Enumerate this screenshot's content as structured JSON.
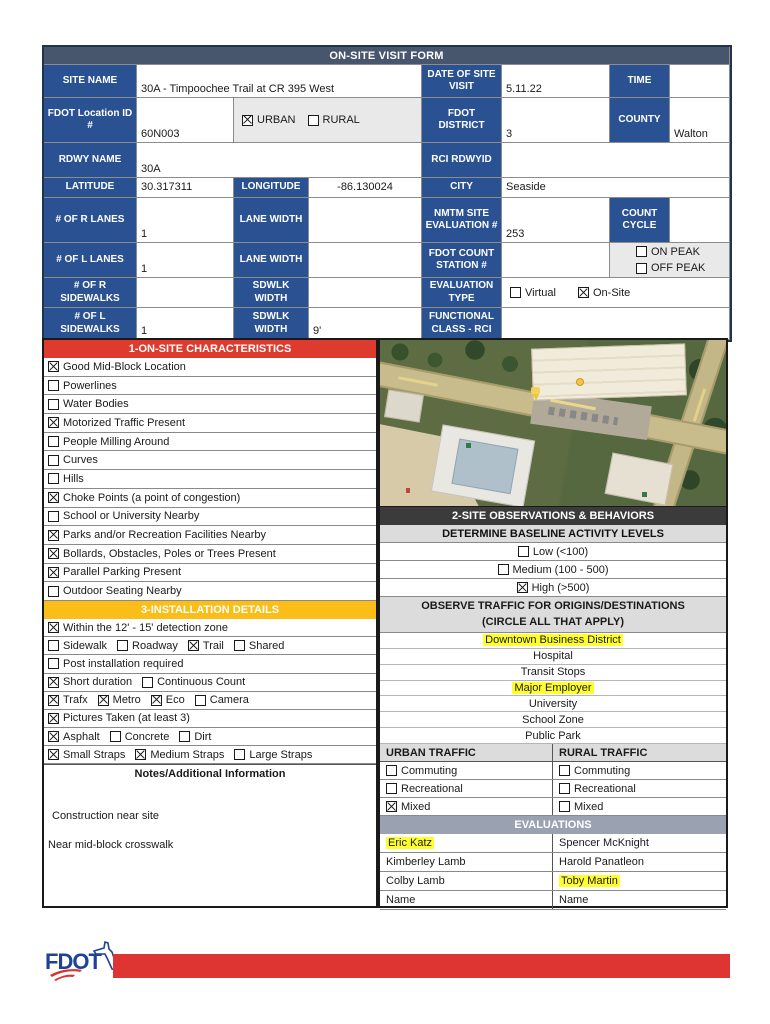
{
  "title": "ON-SITE VISIT FORM",
  "colors": {
    "header_slate": "#47566c",
    "label_blue": "#2a5192",
    "section1_red": "#de3a2e",
    "section3_yellow": "#fbbe18",
    "section2_dark": "#3b3b3b",
    "subheader_gray": "#dcdcdc",
    "evaluations_gray_blue": "#9aa2b2",
    "highlight_yellow": "#ffff2e",
    "footer_red": "#de3532",
    "fdot_logo_blue": "#1e4296"
  },
  "fields": {
    "site_name_label": "SITE NAME",
    "site_name": "30A - Timpoochee Trail at CR 395 West",
    "date_label": "DATE OF SITE VISIT",
    "date": "5.11.22",
    "time_label": "TIME",
    "time": "",
    "fdot_loc_label": "FDOT Location ID #",
    "fdot_loc": "60N003",
    "urban": {
      "label": "URBAN",
      "checked": true
    },
    "rural": {
      "label": "RURAL",
      "checked": false
    },
    "district_label": "FDOT DISTRICT",
    "district": "3",
    "county_label": "COUNTY",
    "county": "Walton",
    "rdwy_label": "RDWY NAME",
    "rdwy": "30A",
    "rci_label": "RCI RDWYID",
    "rci": "",
    "lat_label": "LATITUDE",
    "lat": "30.317311",
    "lon_label": "LONGITUDE",
    "lon": "-86.130024",
    "city_label": "CITY",
    "city": "Seaside",
    "r_lanes_label": "# OF R LANES",
    "r_lanes": "1",
    "lane_width_label": "LANE WIDTH",
    "lane_width_r": "",
    "lane_width_l": "",
    "nmtm_label": "NMTM SITE EVALUATION #",
    "nmtm": "253",
    "count_cycle_label": "COUNT CYCLE",
    "count_cycle": "",
    "l_lanes_label": "# OF L LANES",
    "l_lanes": "1",
    "fdot_count_label": "FDOT COUNT STATION #",
    "fdot_count": "",
    "on_peak": {
      "label": "ON PEAK",
      "checked": false
    },
    "off_peak": {
      "label": "OFF PEAK",
      "checked": false
    },
    "r_sidewalks_label": "# OF R SIDEWALKS",
    "r_sidewalks": "",
    "sdwlk_width_label": "SDWLK WIDTH",
    "sdwlk_width_r": "",
    "sdwlk_width_l": "9'",
    "eval_type_label": "EVALUATION TYPE",
    "virtual": {
      "label": "Virtual",
      "checked": false
    },
    "onsite": {
      "label": "On-Site",
      "checked": true
    },
    "l_sidewalks_label": "# OF L SIDEWALKS",
    "l_sidewalks": "1",
    "func_class_label": "FUNCTIONAL CLASS - RCI",
    "func_class": ""
  },
  "section1": {
    "title": "1-ON-SITE CHARACTERISTICS",
    "items": [
      {
        "label": "Good Mid-Block Location",
        "checked": true
      },
      {
        "label": "Powerlines",
        "checked": false
      },
      {
        "label": "Water Bodies",
        "checked": false
      },
      {
        "label": "Motorized Traffic Present",
        "checked": true
      },
      {
        "label": "People Milling Around",
        "checked": false
      },
      {
        "label": "Curves",
        "checked": false
      },
      {
        "label": "Hills",
        "checked": false
      },
      {
        "label": "Choke Points (a point of congestion)",
        "checked": true
      },
      {
        "label": "School or University Nearby",
        "checked": false
      },
      {
        "label": "Parks and/or Recreation Facilities Nearby",
        "checked": true
      },
      {
        "label": "Bollards, Obstacles, Poles or Trees Present",
        "checked": true
      },
      {
        "label": "Parallel Parking Present",
        "checked": true
      },
      {
        "label": "Outdoor Seating Nearby",
        "checked": false
      }
    ]
  },
  "section3": {
    "title": "3-INSTALLATION DETAILS",
    "rows": [
      [
        {
          "label": "Within the 12' - 15' detection zone",
          "checked": true
        }
      ],
      [
        {
          "label": "Sidewalk",
          "checked": false
        },
        {
          "label": "Roadway",
          "checked": false
        },
        {
          "label": "Trail",
          "checked": true
        },
        {
          "label": "Shared",
          "checked": false
        }
      ],
      [
        {
          "label": "Post installation required",
          "checked": false
        }
      ],
      [
        {
          "label": "Short duration",
          "checked": true
        },
        {
          "label": "Continuous Count",
          "checked": false
        }
      ],
      [
        {
          "label": "Trafx",
          "checked": true
        },
        {
          "label": "Metro",
          "checked": true
        },
        {
          "label": "Eco",
          "checked": true
        },
        {
          "label": "Camera",
          "checked": false
        }
      ],
      [
        {
          "label": "Pictures Taken (at least 3)",
          "checked": true
        }
      ],
      [
        {
          "label": "Asphalt",
          "checked": true
        },
        {
          "label": "Concrete",
          "checked": false
        },
        {
          "label": "Dirt",
          "checked": false
        }
      ],
      [
        {
          "label": "Small Straps",
          "checked": true
        },
        {
          "label": "Medium Straps",
          "checked": true
        },
        {
          "label": "Large Straps",
          "checked": false
        }
      ]
    ]
  },
  "notes": {
    "title": "Notes/Additional Information",
    "lines": [
      "Construction near site",
      "Near mid-block crosswalk"
    ]
  },
  "section2": {
    "title": "2-SITE OBSERVATIONS & BEHAVIORS",
    "baseline_title": "DETERMINE BASELINE ACTIVITY LEVELS",
    "levels": [
      {
        "label": "Low (<100)",
        "checked": false
      },
      {
        "label": "Medium (100 - 500)",
        "checked": false
      },
      {
        "label": "High (>500)",
        "checked": true
      }
    ],
    "observe_title_1": "OBSERVE TRAFFIC FOR ORIGINS/DESTINATIONS",
    "observe_title_2": "(CIRCLE ALL THAT APPLY)",
    "destinations": [
      {
        "label": "Downtown Business District",
        "highlighted": true
      },
      {
        "label": "Hospital",
        "highlighted": false
      },
      {
        "label": "Transit Stops",
        "highlighted": false
      },
      {
        "label": "Major Employer",
        "highlighted": true
      },
      {
        "label": "University",
        "highlighted": false
      },
      {
        "label": "School Zone",
        "highlighted": false
      },
      {
        "label": "Public Park",
        "highlighted": false
      }
    ]
  },
  "traffic": {
    "urban_title": "URBAN TRAFFIC",
    "rural_title": "RURAL TRAFFIC",
    "urban": [
      {
        "label": "Commuting",
        "checked": false
      },
      {
        "label": "Recreational",
        "checked": false
      },
      {
        "label": "Mixed",
        "checked": true
      }
    ],
    "rural": [
      {
        "label": "Commuting",
        "checked": false
      },
      {
        "label": "Recreational",
        "checked": false
      },
      {
        "label": "Mixed",
        "checked": false
      }
    ]
  },
  "evaluations": {
    "title": "EVALUATIONS",
    "left": [
      {
        "name": "Eric Katz",
        "highlighted": true
      },
      {
        "name": "Kimberley Lamb",
        "highlighted": false
      },
      {
        "name": "Colby Lamb",
        "highlighted": false
      },
      {
        "name": "Name",
        "highlighted": false
      }
    ],
    "right": [
      {
        "name": "Spencer McKnight",
        "highlighted": false
      },
      {
        "name": "Harold Panatleon",
        "highlighted": false
      },
      {
        "name": "Toby Martin",
        "highlighted": true
      },
      {
        "name": "Name",
        "highlighted": false
      }
    ]
  },
  "footer": {
    "logo_text": "FDOT"
  }
}
